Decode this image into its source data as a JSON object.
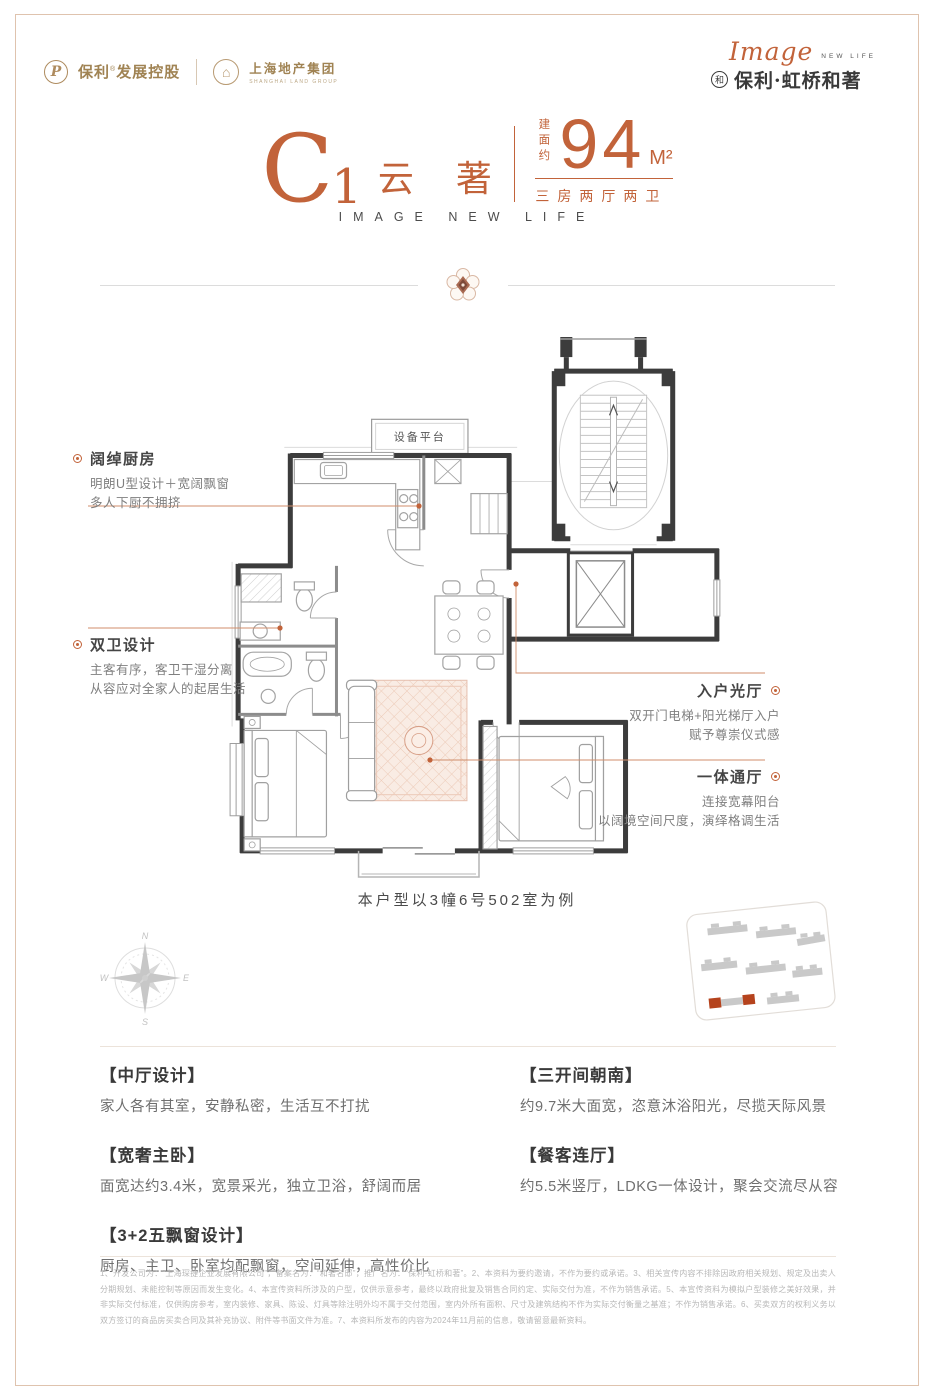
{
  "colors": {
    "accent": "#c2633a",
    "leader": "#d08e6b",
    "wall": "#3c3c3c",
    "logo_tan": "#a08353",
    "site_highlight": "#b5431d"
  },
  "brand": {
    "poly": {
      "icon": "P",
      "name": "保利",
      "reg": "®",
      "suffix": "发展控股"
    },
    "shland": {
      "icon": "⌂",
      "cn": "上海地产集团",
      "en": "SHANGHAI LAND GROUP"
    },
    "project": {
      "script": "Image",
      "sub": "NEW LIFE",
      "icon": "和",
      "name": "保利·虹桥和著"
    }
  },
  "title": {
    "letter": "C",
    "num": "1",
    "name": "云 著",
    "area_label": "建面约",
    "area": "94",
    "unit": "M²",
    "rooms": "三房两厅两卫",
    "tagline": "IMAGE NEW LIFE"
  },
  "plan": {
    "platform": "设备平台",
    "caption": "本户型以3幢6号502室为例",
    "ann_kitchen": {
      "title": "阔绰厨房",
      "l1": "明朗U型设计＋宽阔飘窗",
      "l2": "多人下厨不拥挤"
    },
    "ann_bath": {
      "title": "双卫设计",
      "l1": "主客有序，客卫干湿分离",
      "l2": "从容应对全家人的起居生活"
    },
    "ann_entry": {
      "title": "入户光厅",
      "l1": "双开门电梯+阳光梯厅入户",
      "l2": "赋予尊崇仪式感"
    },
    "ann_hall": {
      "title": "一体通厅",
      "l1": "连接宽幕阳台",
      "l2": "以阔境空间尺度，演绎格调生活"
    },
    "compass": {
      "n": "N",
      "e": "E",
      "s": "S",
      "w": "W"
    }
  },
  "features": {
    "left": [
      {
        "title": "【中厅设计】",
        "desc": "家人各有其室，安静私密，生活互不打扰"
      },
      {
        "title": "【宽奢主卧】",
        "desc": "面宽达约3.4米，宽景采光，独立卫浴，舒阔而居"
      },
      {
        "title": "【3+2五飘窗设计】",
        "desc": "厨房、主卫、卧室均配飘窗，空间延伸，高性价比"
      }
    ],
    "right": [
      {
        "title": "【三开间朝南】",
        "desc": "约9.7米大面宽，恣意沐浴阳光，尽揽天际风景"
      },
      {
        "title": "【餐客连厅】",
        "desc": "约5.5米竖厅，LDKG一体设计，聚会交流尽从容"
      }
    ]
  },
  "footer": {
    "disclaimer": "1、开发公司为：“上海琛捷企业发展有限公司”，备案名为：“和著名邸”，推广名为：“保利·虹桥和著”。2、本资料为要约邀请，不作为要约或承诺。3、相关宣传内容不排除因政府相关规划、规定及出卖人分期规划、未能控制等原因而发生变化。4、本宣传资料所涉及的户型，仅供示意参考，最终以政府批复及销售合同约定、实际交付为准，不作为销售承诺。5、本宣传资料为模拟户型装修之美好效果，并非实际交付标准，仅供购房参考，室内装修、家具、陈设、灯具等除注明外均不属于交付范围，室内外所有面积、尺寸及建筑结构不作为实际交付衡量之基准；不作为销售承诺。6、买卖双方的权利义务以双方签订的商品房买卖合同及其补充协议、附件等书面文件为准。7、本资料所发布的内容为2024年11月前的信息，敬请留意最新资料。"
  }
}
